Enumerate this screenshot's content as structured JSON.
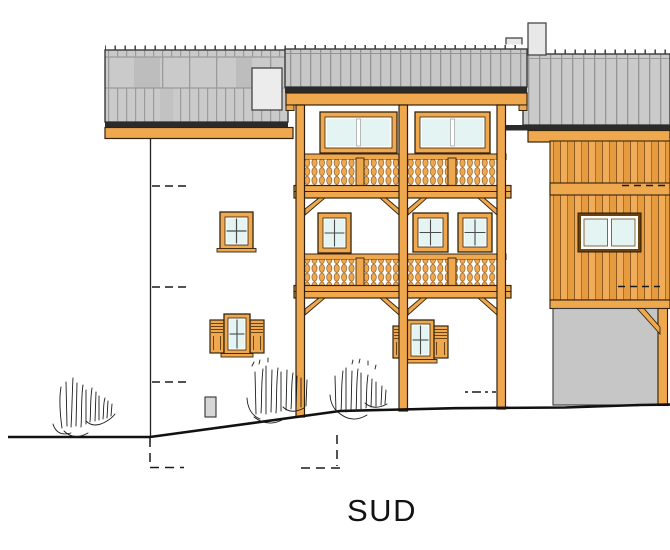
{
  "elevation": {
    "label": "SUD",
    "drawing_type": "architectural elevation drawing, south facade",
    "colors": {
      "background": "#FFFFFF",
      "wood_orange": "#F0A84E",
      "wood_board_alt": "#E69B3E",
      "wood_outline": "#4A3310",
      "roof_gray": "#CACACA",
      "roof_seam": "#9B9B9B",
      "roof_panel_dark": "#BDBDBD",
      "eave_dark": "#2B2B2B",
      "chimney_gray": "#E8E8E8",
      "garage_gray": "#C6C6C6",
      "utility_box_gray": "#D6D6D6",
      "glass_cyan": "#E4F4F2",
      "line_black": "#1A1A1A"
    },
    "features": {
      "chimneys": 2,
      "balcony_levels": 2,
      "shuttered_windows": 2,
      "label_position": "bottom-center"
    }
  }
}
